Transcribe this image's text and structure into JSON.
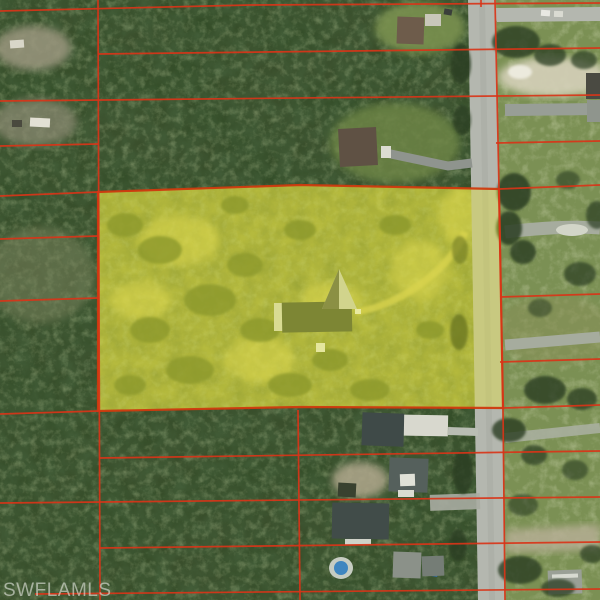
{
  "watermark": {
    "text": "SWFLAMLS"
  },
  "palette": {
    "parcel_line": "#d93418",
    "highlight_fill": "#f2ef1e",
    "highlight_fill_opacity": 0.32,
    "highlight_border": "#cf3a0e",
    "forest_base": "#3a4f2c",
    "lawn_base": "#7b9054",
    "parcel_ground": "#99a14d",
    "road_fill": "#b4b7af",
    "pool_blue": "#3f86c0",
    "watermark_color": "rgba(226,229,221,0.62)"
  },
  "highlight_parcel": {
    "points": [
      [
        98,
        192
      ],
      [
        300,
        185
      ],
      [
        499,
        189
      ],
      [
        503,
        408
      ],
      [
        300,
        407
      ],
      [
        98,
        411
      ]
    ]
  },
  "road_boundary": [
    [
      495,
      0
    ],
    [
      499,
      189
    ],
    [
      503,
      408
    ],
    [
      505,
      600
    ]
  ],
  "parcel_lines": [
    [
      0,
      11,
      250,
      5
    ],
    [
      250,
      5,
      600,
      3
    ],
    [
      98,
      54,
      600,
      48
    ],
    [
      0,
      101,
      600,
      95
    ],
    [
      0,
      146,
      98,
      144
    ],
    [
      496,
      143,
      600,
      141
    ],
    [
      0,
      196,
      98,
      192
    ],
    [
      499,
      189,
      600,
      185
    ],
    [
      0,
      239,
      98,
      236
    ],
    [
      0,
      301,
      98,
      298
    ],
    [
      500,
      297,
      600,
      294
    ],
    [
      500,
      362,
      600,
      359
    ],
    [
      0,
      414,
      98,
      411
    ],
    [
      503,
      408,
      600,
      405
    ],
    [
      99,
      458,
      600,
      451
    ],
    [
      0,
      503,
      600,
      497
    ],
    [
      100,
      548,
      600,
      542
    ],
    [
      35,
      594,
      600,
      589
    ],
    [
      98,
      0,
      100,
      600
    ],
    [
      298,
      410,
      300,
      600
    ],
    [
      481,
      0,
      481,
      7
    ]
  ]
}
